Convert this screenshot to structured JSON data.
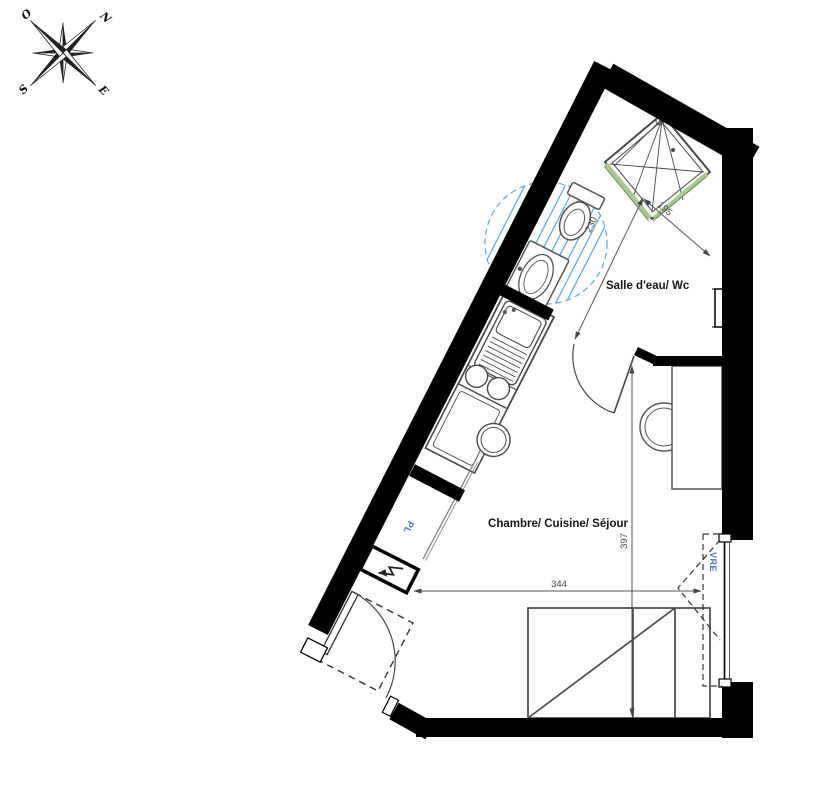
{
  "title": "Studio apartment floor plan",
  "compass": {
    "north": "N",
    "west": "O",
    "south": "S",
    "east": "E"
  },
  "rooms": {
    "bathroom": "Salle d'eau/ Wc",
    "main": "Chambre/ Cuisine/ Séjour"
  },
  "annotations": {
    "closet": "PL",
    "shutter": "VRE",
    "turning_circle": "Ø150"
  },
  "dimensions": {
    "bathroom_width": "195",
    "bathroom_depth": "230",
    "room_width": "344",
    "room_depth": "397"
  },
  "colors": {
    "wall": "#000000",
    "furniture_line": "#4a4a4a",
    "hatch_blue": "#57a8e0",
    "shower_screen_green": "#a9c98f",
    "blue_label": "#4a6fa8",
    "dim_text": "#44464f",
    "room_text": "#161616"
  }
}
